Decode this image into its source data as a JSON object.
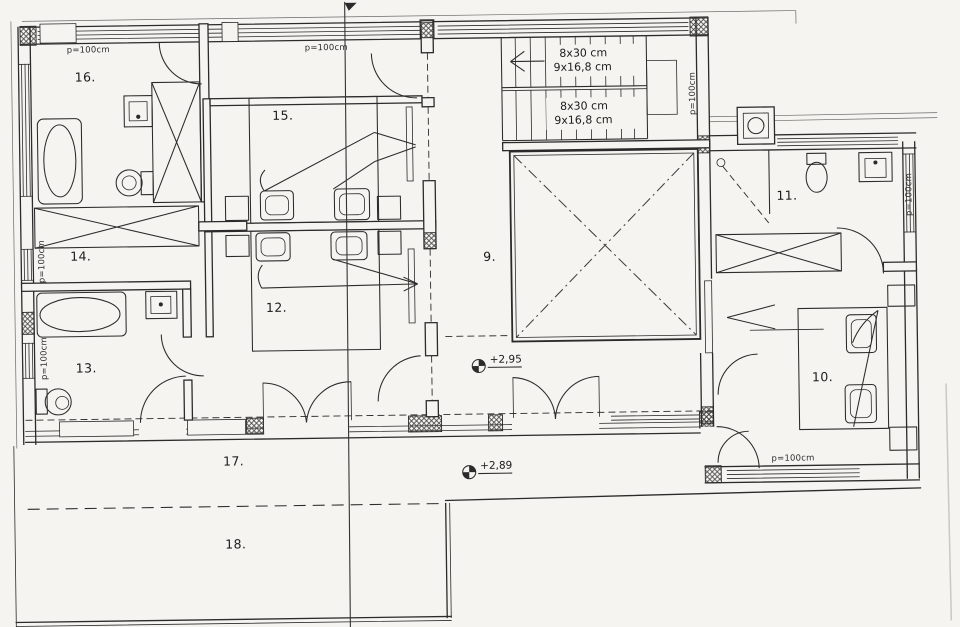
{
  "drawing_type": "architectural floor plan (scanned, upper storey)",
  "colors": {
    "ink": "#2b2b2b",
    "paper": "#f5f4f0"
  },
  "room_labels": [
    "16.",
    "15.",
    "14.",
    "13.",
    "12.",
    "9.",
    "11.",
    "10.",
    "17.",
    "18."
  ],
  "stair_labels": [
    "8x30 cm",
    "9x16,8 cm",
    "8x30 cm",
    "9x16,8 cm"
  ],
  "level_markers": [
    "+2,95",
    "+2,89"
  ],
  "parapet_labels": [
    "p=100cm",
    "p=100cm",
    "p=100cm",
    "p=100cm",
    "p=100cm",
    "p=100cm",
    "p=100cm"
  ]
}
